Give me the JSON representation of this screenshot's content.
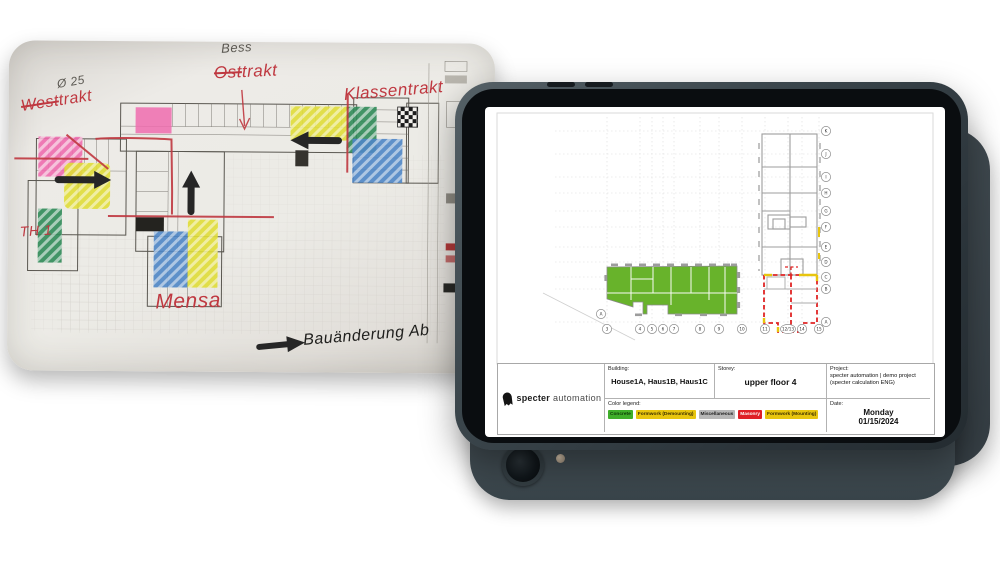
{
  "paper": {
    "annotations": {
      "pencil_top": "Bess",
      "diameter_note": "Ø 25",
      "west_wing_struck": "West",
      "west_wing_rest": "trakt",
      "east_wing_struck": "Ost",
      "east_wing_rest": "trakt",
      "class_wing": "Klassentrakt",
      "th_note": "TH 1",
      "mensa": "Mensa",
      "bottom_note": "Bauänderung Ab"
    },
    "highlight_colors": {
      "pink": "#ee6cae",
      "yellow": "#e5e23e",
      "green": "#2f8a58",
      "blue": "#4e86c6",
      "red_pen": "#bf3840"
    }
  },
  "tablet": {
    "logo": {
      "brand_bold": "specter",
      "brand_light": "automation"
    },
    "info": {
      "building_label": "Building:",
      "building_value": "House1A, Haus1B, Haus1C",
      "storey_label": "Storey:",
      "storey_value": "upper floor 4",
      "project_label": "Project:",
      "project_value": "specter automation | demo project (specter calculation ENG)",
      "legend_label": "Color legend:",
      "date_label": "Date:",
      "date_day": "Monday",
      "date_value": "01/15/2024"
    },
    "legend": [
      {
        "label": "Concrete",
        "color": "#3fae2a",
        "text": "#0c3a06"
      },
      {
        "label": "Formwork (Demounting)",
        "color": "#e8c50e",
        "text": "#3d3000"
      },
      {
        "label": "Miscellaneous",
        "color": "#b7b7b7",
        "text": "#1e1e1e"
      },
      {
        "label": "Masonry",
        "color": "#df1f26",
        "text": "#ffffff"
      },
      {
        "label": "Formwork (Mounting)",
        "color": "#e8c50e",
        "text": "#3d3000"
      }
    ],
    "plan": {
      "row_labels": [
        "K",
        "J",
        "I",
        "H",
        "G",
        "F",
        "E",
        "D",
        "C",
        "B",
        "A"
      ],
      "col_labels": [
        "3",
        "4",
        "5",
        "6",
        "7",
        "8",
        "9",
        "10",
        "11",
        "12/13",
        "14",
        "15"
      ],
      "corner_label": "A",
      "green_fill": "#68b32b",
      "red_dash": "#e02424",
      "yellow_mark": "#e8c50e"
    }
  }
}
